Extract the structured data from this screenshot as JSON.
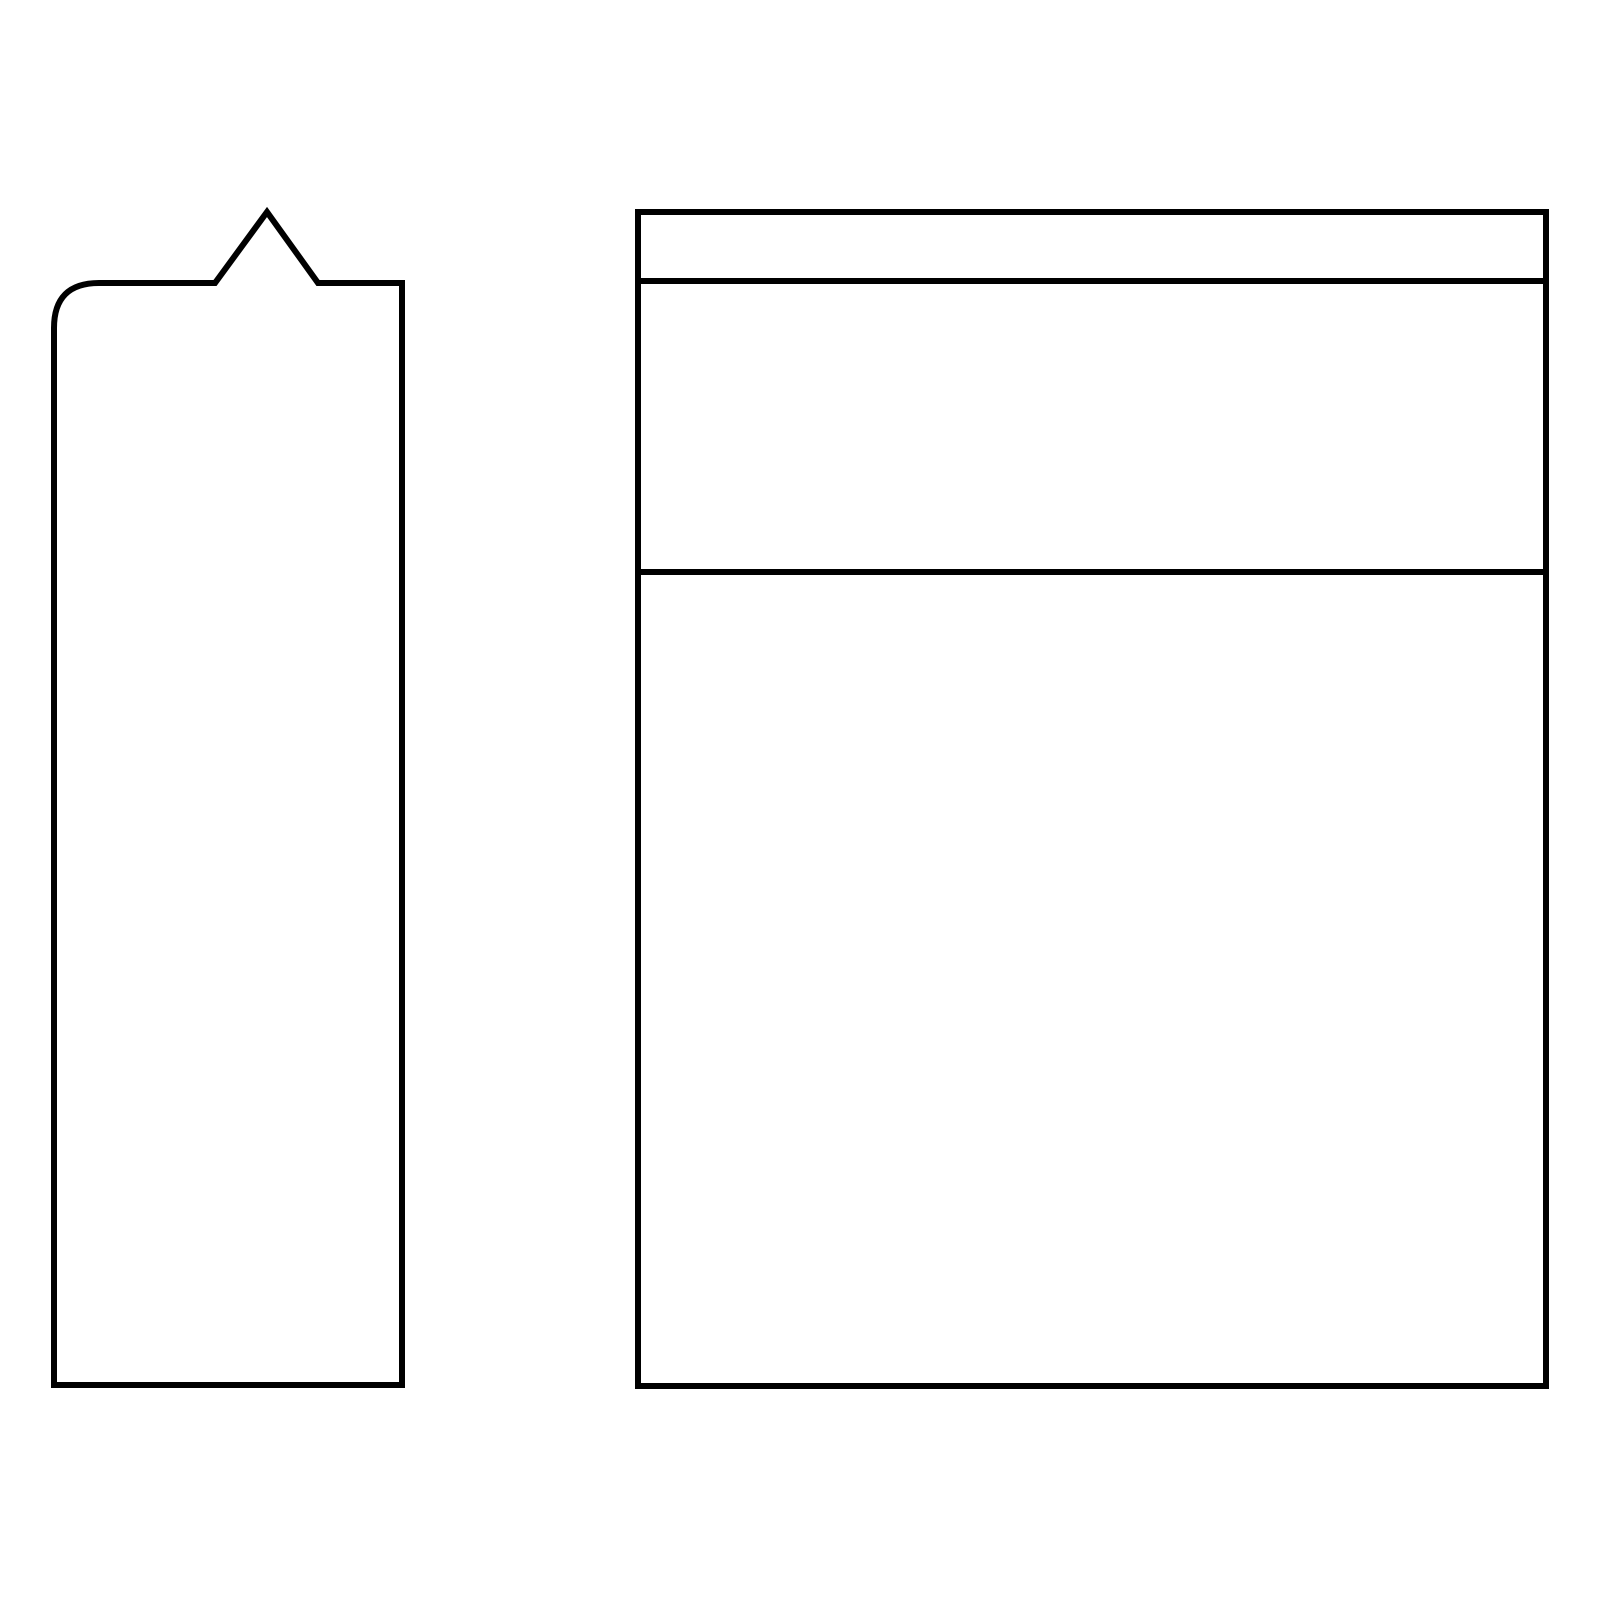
{
  "canvas": {
    "width": 1600,
    "height": 1600,
    "background": "#ffffff"
  },
  "drawing": {
    "stroke_color": "#000000",
    "stroke_width": 6,
    "shapes": {
      "notched_panel": {
        "description": "tall-rounded-panel-with-triangular-pointer-on-top",
        "path": "M 99 283 L 215 283 L 267 212 L 318 283 L 402 283 L 402 1385 L 54 1385 L 54 328 Q 54 283 99 283 Z"
      },
      "card_outline": {
        "description": "large-rectangle-card-outline",
        "path": "M 638 212 L 1546 212 L 1546 1386 L 638 1386 Z"
      },
      "card_top_divider": {
        "description": "upper-horizontal-divider-line",
        "path": "M 638 281 L 1546 281"
      },
      "card_middle_divider": {
        "description": "lower-horizontal-divider-line",
        "path": "M 638 572 L 1546 572"
      }
    }
  }
}
